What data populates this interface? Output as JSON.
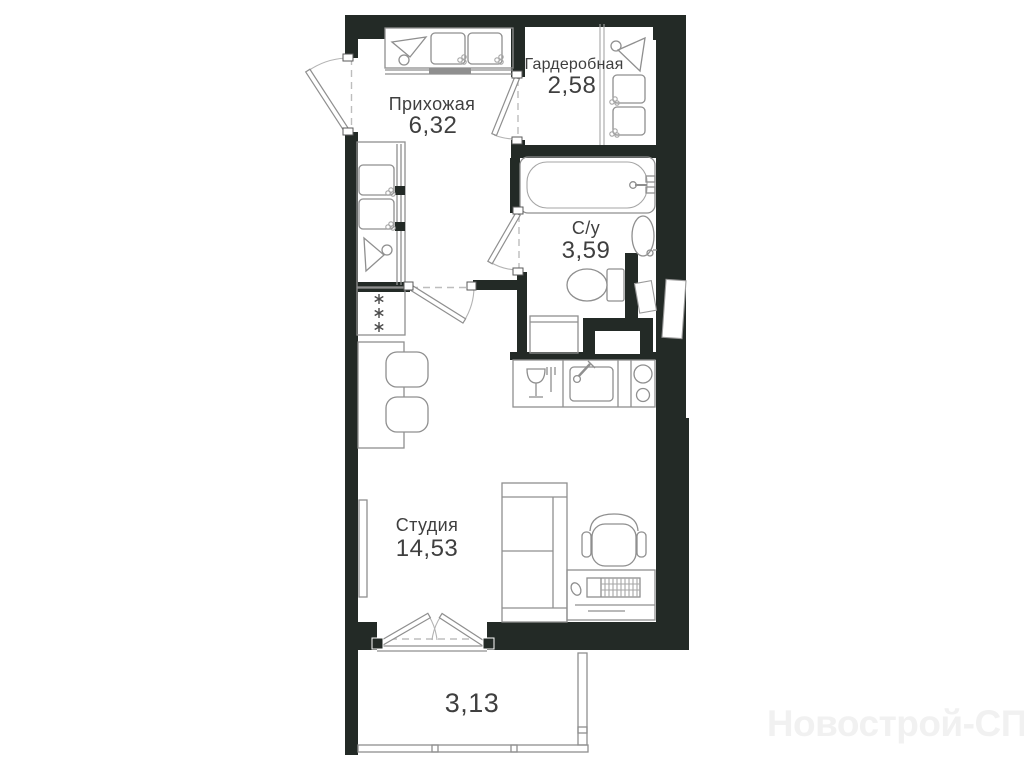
{
  "plan": {
    "title": "studio apartment floor plan",
    "rooms": [
      {
        "id": "hallway",
        "name": "Прихожая",
        "area": "6,32"
      },
      {
        "id": "wardrobe",
        "name": "Гардеробная",
        "area": "2,58"
      },
      {
        "id": "bathroom",
        "name": "С/у",
        "area": "3,59"
      },
      {
        "id": "studio",
        "name": "Студия",
        "area": "14,53"
      },
      {
        "id": "balcony",
        "name": "",
        "area": "3,13"
      }
    ],
    "watermark": "Новострой-СПб",
    "colors": {
      "background": "#ffffff",
      "wall": "#232a26",
      "furniture_line": "#8f8f8f",
      "text": "#3f3f3f",
      "watermark": "#f1f1f1"
    },
    "icons": [
      "hanger-icon",
      "storage-box-icon",
      "fridge-icon",
      "dining-table-icon",
      "chair-icon",
      "bathtub-icon",
      "washbasin-icon",
      "toilet-icon",
      "washing-machine-icon",
      "dishwasher-icon",
      "kitchen-sink-icon",
      "stove-icon",
      "bed-icon",
      "office-chair-icon",
      "desk-icon",
      "keyboard-icon",
      "mouse-icon",
      "radiator-icon",
      "balcony-glazing"
    ]
  }
}
